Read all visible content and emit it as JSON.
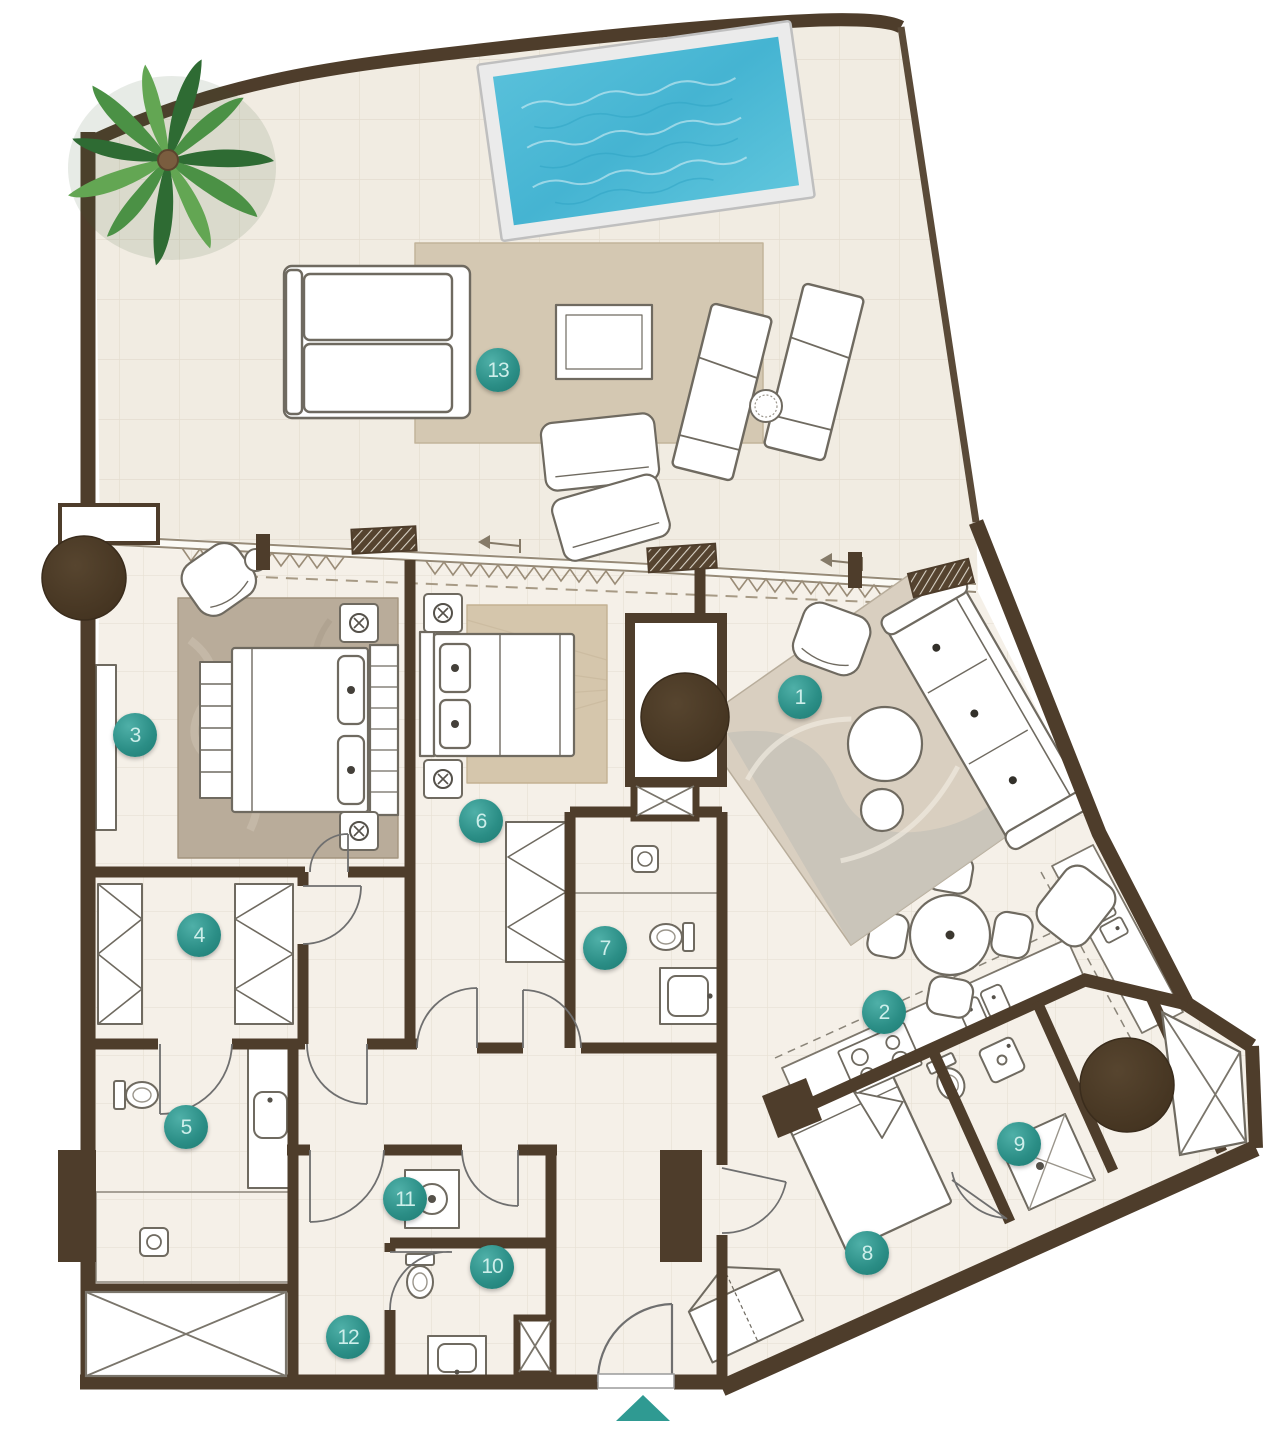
{
  "plan": {
    "room_labels": [
      {
        "number": "1",
        "x": 800,
        "y": 697
      },
      {
        "number": "2",
        "x": 884,
        "y": 1012
      },
      {
        "number": "3",
        "x": 135,
        "y": 735
      },
      {
        "number": "4",
        "x": 199,
        "y": 935
      },
      {
        "number": "5",
        "x": 186,
        "y": 1127
      },
      {
        "number": "6",
        "x": 481,
        "y": 821
      },
      {
        "number": "7",
        "x": 605,
        "y": 948
      },
      {
        "number": "8",
        "x": 867,
        "y": 1253
      },
      {
        "number": "9",
        "x": 1019,
        "y": 1144
      },
      {
        "number": "10",
        "x": 492,
        "y": 1267
      },
      {
        "number": "11",
        "x": 405,
        "y": 1199
      },
      {
        "number": "12",
        "x": 348,
        "y": 1337
      },
      {
        "number": "13",
        "x": 498,
        "y": 370
      }
    ],
    "entrance": {
      "icon": "entrance-arrow",
      "x": 643,
      "y": 1408
    },
    "colors": {
      "wall": "#4e3d2b",
      "terrace_floor": "#f1ece2",
      "interior_floor": "#f5f0e8",
      "pool_water": "#4cb9d6",
      "pool_deck": "#ebebeb",
      "label_bg": "#2b8e86",
      "label_hi": "#4fb0a8",
      "label_lo": "#1d7a72",
      "label_text": "#cdeeea",
      "accent_teal": "#2f9a92",
      "palm_green": "#4b9145",
      "rug_terrace": "#d4c8b2",
      "rug_master": "#b9ac9a",
      "rug_bedroom2": "#d5c6ac"
    },
    "features": [
      "pool",
      "palm-tree",
      "lounge-chairs",
      "outdoor-sofa",
      "outdoor-coffee-table",
      "double-beds",
      "single-bed",
      "wardrobes",
      "bathrooms",
      "kitchen-counter",
      "dining-table",
      "sofa",
      "structural-columns",
      "service-shafts",
      "entrance-arrow",
      "sliding-door-arrows"
    ]
  }
}
